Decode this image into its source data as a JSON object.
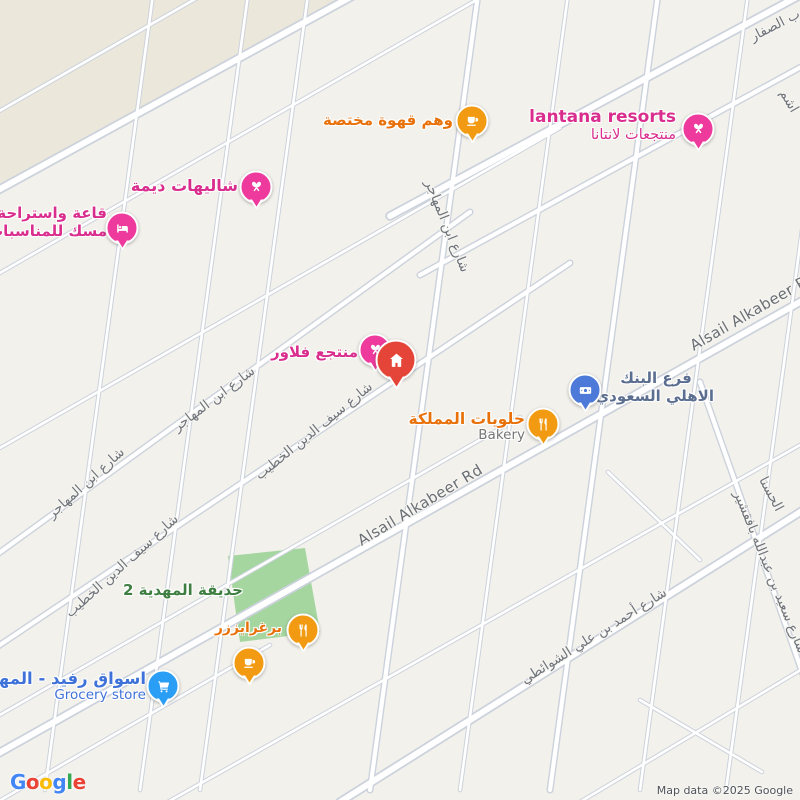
{
  "colors": {
    "land": "#f2f1ec",
    "district_beige": "#ebe7db",
    "park_green": "#a5d6a0",
    "road_fill": "#ffffff",
    "road_casing": "#ccd2dc",
    "poi_pink": "#ee3a9c",
    "poi_pink_text": "#d92e8e",
    "poi_orange": "#f29b12",
    "poi_orange_text": "#e8710a",
    "poi_bank_blue": "#4d7ad9",
    "poi_bank_text": "#5b6e90",
    "poi_cart_blue": "#2a9df4",
    "poi_grocery_text": "#3f72d9",
    "poi_red_marker": "#e54538",
    "park_text": "#3e7e41",
    "road_label": "#6f747b"
  },
  "pois": {
    "lantana": {
      "title": "lantana resorts",
      "subtitle": "منتجعات لانتانا"
    },
    "waham_coffee": {
      "title": "وهم قهوة مختصة"
    },
    "dima_chalets": {
      "title": "شاليهات ديمة"
    },
    "misk_hall": {
      "line1": "قاعة واستراحة",
      "line2": "مسك للمناسبات"
    },
    "flower_resort": {
      "title": "منتجع فلاور"
    },
    "bank": {
      "line1": "فرع البنك",
      "line2": "الاهلي السعودي"
    },
    "bakery": {
      "title": "حلويات المملكة",
      "subtitle": "Bakery"
    },
    "park": {
      "title": "حديقة المهدية 2"
    },
    "burger": {
      "title": "برغرايززر"
    },
    "grocery": {
      "title": "اسواق رفيد - المهدية",
      "subtitle": "Grocery store"
    }
  },
  "roads": {
    "alsail": "Alsail Alkabeer Rd",
    "ibn_almuhajir": "شارع ابن المهاجر",
    "saif_aldin": "شارع سيف الدين الخطيب",
    "ahmad_shawaiti": "شارع أحمد بن علي الشوائطي",
    "saeed_bafaqshir": "شارع سعيد بن عبدالله بافقشير",
    "alhasna": "الحسنا",
    "alsaffar": "وب الصفار",
    "hashem": "اشم"
  },
  "footer": {
    "logo": "Google",
    "logo_letters": [
      "G",
      "o",
      "o",
      "g",
      "l",
      "e"
    ],
    "logo_colors": [
      "#4285F4",
      "#EA4335",
      "#FBBC05",
      "#4285F4",
      "#34A853",
      "#EA4335"
    ],
    "attribution": "Map data ©2025 Google"
  }
}
